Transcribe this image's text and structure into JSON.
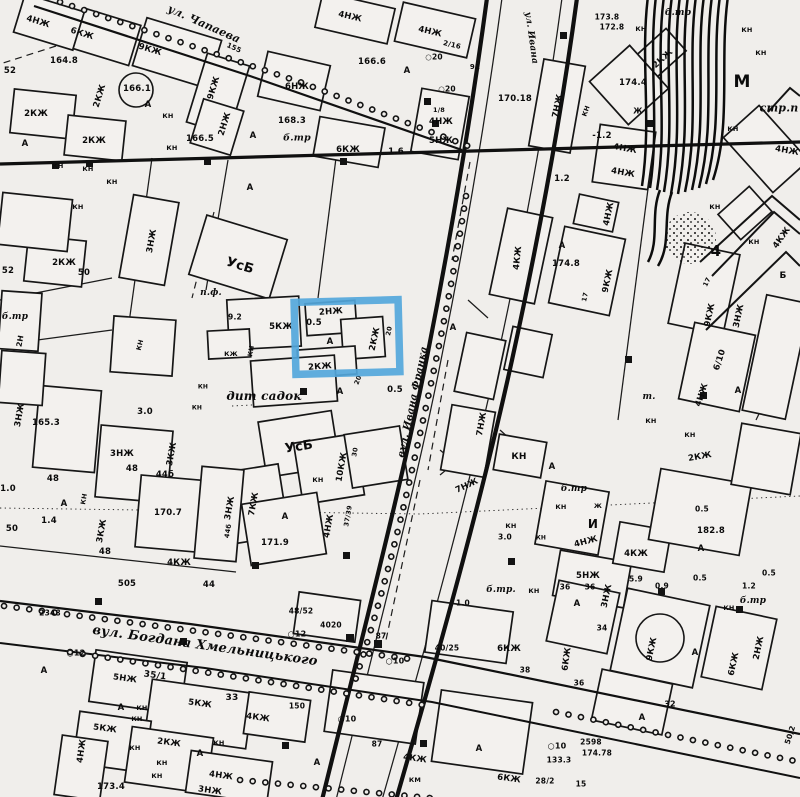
{
  "document": {
    "type": "scanned black-and-white city topographic map",
    "language": "Ukrainian / Russian",
    "annotation": "blue rectangle highlight over one building block"
  },
  "streets": [
    "ул. Чапаева",
    "вул. Ивана Франка",
    "вул. Богдана Хмельницького"
  ],
  "highlight": {
    "x": 295,
    "y": 301,
    "width": 104,
    "height": 72,
    "rotation": -1.5,
    "color": "#54a7db",
    "stroke_width": 7.5
  },
  "labels": [
    {
      "t": "4НЖ",
      "x": 38,
      "y": 22,
      "r": 17
    },
    {
      "t": "6КЖ",
      "x": 82,
      "y": 34,
      "r": 17
    },
    {
      "t": "9КЖ",
      "x": 150,
      "y": 50,
      "r": 17
    },
    {
      "t": "ул. Чапаева",
      "x": 204,
      "y": 24,
      "r": 24,
      "s": 11,
      "st": 1
    },
    {
      "t": "155",
      "x": 234,
      "y": 48,
      "r": 24,
      "s": 7
    },
    {
      "t": "164.8",
      "x": 64,
      "y": 61
    },
    {
      "t": "166.1",
      "x": 137,
      "y": 89
    },
    {
      "t": "2КЖ",
      "x": 100,
      "y": 96,
      "r": -73
    },
    {
      "t": "2КЖ",
      "x": 36,
      "y": 114
    },
    {
      "t": "2КЖ",
      "x": 94,
      "y": 141
    },
    {
      "t": "166.5",
      "x": 200,
      "y": 139
    },
    {
      "t": "КН",
      "x": 168,
      "y": 116,
      "s": 6.5
    },
    {
      "t": "КН",
      "x": 172,
      "y": 148,
      "s": 6.5
    },
    {
      "t": "КН",
      "x": 58,
      "y": 166,
      "s": 6.5
    },
    {
      "t": "КН",
      "x": 88,
      "y": 169,
      "s": 6.5
    },
    {
      "t": "КН",
      "x": 112,
      "y": 182,
      "s": 6.5
    },
    {
      "t": "9КЖ",
      "x": 214,
      "y": 88,
      "r": -73
    },
    {
      "t": "2НЖ",
      "x": 225,
      "y": 124,
      "r": -73
    },
    {
      "t": "52",
      "x": 10,
      "y": 71
    },
    {
      "t": "А",
      "x": 25,
      "y": 144
    },
    {
      "t": "А",
      "x": 148,
      "y": 105
    },
    {
      "t": "А",
      "x": 253,
      "y": 136
    },
    {
      "t": "А",
      "x": 250,
      "y": 188
    },
    {
      "t": "4НЖ",
      "x": 350,
      "y": 17,
      "r": 13
    },
    {
      "t": "4НЖ",
      "x": 430,
      "y": 32,
      "r": 13
    },
    {
      "t": "2/16",
      "x": 452,
      "y": 45,
      "r": 13,
      "s": 7
    },
    {
      "t": "166.6",
      "x": 372,
      "y": 62
    },
    {
      "t": "А",
      "x": 407,
      "y": 71
    },
    {
      "t": "○20",
      "x": 434,
      "y": 57,
      "s": 7.5
    },
    {
      "t": "○20",
      "x": 447,
      "y": 89,
      "s": 7.5
    },
    {
      "t": "6НЖ",
      "x": 297,
      "y": 87
    },
    {
      "t": "168.3",
      "x": 292,
      "y": 121
    },
    {
      "t": "б.тр",
      "x": 297,
      "y": 138,
      "s": 9.5,
      "st": 1
    },
    {
      "t": "6КЖ",
      "x": 348,
      "y": 150
    },
    {
      "t": "1.6",
      "x": 396,
      "y": 152
    },
    {
      "t": "1/8",
      "x": 439,
      "y": 110,
      "s": 6.5
    },
    {
      "t": "4НЖ",
      "x": 441,
      "y": 122
    },
    {
      "t": "5НЖ",
      "x": 441,
      "y": 141
    },
    {
      "t": "92",
      "x": 475,
      "y": 67,
      "s": 7
    },
    {
      "t": "170.18",
      "x": 515,
      "y": 99
    },
    {
      "t": "ул. Ивана",
      "x": 531,
      "y": 38,
      "r": 82,
      "s": 9,
      "st": 1
    },
    {
      "t": "173.8",
      "x": 607,
      "y": 17,
      "s": 7.5
    },
    {
      "t": "172.8",
      "x": 612,
      "y": 27,
      "s": 7.5
    },
    {
      "t": "б.тр",
      "x": 678,
      "y": 13,
      "s": 9,
      "st": 1
    },
    {
      "t": "КН",
      "x": 641,
      "y": 29,
      "s": 6.5
    },
    {
      "t": "КН",
      "x": 747,
      "y": 30,
      "s": 6.5
    },
    {
      "t": "КН",
      "x": 761,
      "y": 53,
      "s": 6.5
    },
    {
      "t": "2КЖ",
      "x": 663,
      "y": 59,
      "r": -42
    },
    {
      "t": "174.4",
      "x": 633,
      "y": 83
    },
    {
      "t": "7НЖ",
      "x": 558,
      "y": 106,
      "r": -78
    },
    {
      "t": "КН",
      "x": 586,
      "y": 111,
      "r": -70,
      "s": 6.5
    },
    {
      "t": "Ж",
      "x": 638,
      "y": 111,
      "s": 7.5
    },
    {
      "t": "-1.2",
      "x": 602,
      "y": 136
    },
    {
      "t": "4НЖ",
      "x": 625,
      "y": 149,
      "r": 10
    },
    {
      "t": "4НЖ",
      "x": 623,
      "y": 173,
      "r": 10
    },
    {
      "t": "1.2",
      "x": 562,
      "y": 179
    },
    {
      "t": "М",
      "x": 742,
      "y": 82,
      "s": 17
    },
    {
      "t": "стр.п",
      "x": 779,
      "y": 108,
      "s": 11,
      "st": 1
    },
    {
      "t": "КН",
      "x": 733,
      "y": 129,
      "s": 6.5
    },
    {
      "t": "4НЖ",
      "x": 787,
      "y": 151,
      "r": 10
    },
    {
      "t": "КН",
      "x": 78,
      "y": 207,
      "s": 6.5
    },
    {
      "t": "3НЖ",
      "x": 152,
      "y": 241,
      "r": -80
    },
    {
      "t": "52",
      "x": 8,
      "y": 271
    },
    {
      "t": "2КЖ",
      "x": 64,
      "y": 263
    },
    {
      "t": "50",
      "x": 84,
      "y": 273
    },
    {
      "t": "б.тр",
      "x": 15,
      "y": 317,
      "s": 9,
      "st": 1
    },
    {
      "t": "2Н",
      "x": 20,
      "y": 341,
      "r": -80,
      "s": 7.5
    },
    {
      "t": "УсБ",
      "x": 240,
      "y": 266,
      "r": 17,
      "s": 13
    },
    {
      "t": "п.ф.",
      "x": 211,
      "y": 293,
      "s": 9,
      "st": 1
    },
    {
      "t": "КН",
      "x": 251,
      "y": 351,
      "r": -80,
      "s": 6.5
    },
    {
      "t": "9.2",
      "x": 235,
      "y": 317,
      "s": 7.5
    },
    {
      "t": "165.3",
      "x": 46,
      "y": 423
    },
    {
      "t": "3НЖ",
      "x": 20,
      "y": 415,
      "r": -80
    },
    {
      "t": "5КЖ",
      "x": 281,
      "y": 327
    },
    {
      "t": "КЖ",
      "x": 231,
      "y": 354,
      "s": 6.5
    },
    {
      "t": "КН",
      "x": 140,
      "y": 345,
      "r": -75,
      "s": 6.5
    },
    {
      "t": "2НЖ",
      "x": 331,
      "y": 312,
      "r": -4
    },
    {
      "t": "0.5",
      "x": 314,
      "y": 323
    },
    {
      "t": "А",
      "x": 330,
      "y": 342
    },
    {
      "t": "2КЖ",
      "x": 375,
      "y": 339,
      "r": -78
    },
    {
      "t": "20",
      "x": 389,
      "y": 331,
      "r": -78,
      "s": 6.5
    },
    {
      "t": "2КЖ",
      "x": 320,
      "y": 367,
      "r": -4
    },
    {
      "t": "20",
      "x": 358,
      "y": 380,
      "r": -70,
      "s": 6.5
    },
    {
      "t": "0.5",
      "x": 395,
      "y": 390
    },
    {
      "t": "А",
      "x": 340,
      "y": 392
    },
    {
      "t": "дит садок",
      "x": 264,
      "y": 396,
      "s": 12,
      "st": 1
    },
    {
      "t": "3.0",
      "x": 145,
      "y": 412
    },
    {
      "t": "КН",
      "x": 203,
      "y": 387,
      "s": 6
    },
    {
      "t": "КН",
      "x": 197,
      "y": 408,
      "s": 6
    },
    {
      "t": "вул. Ивана Франка",
      "x": 413,
      "y": 402,
      "r": -78,
      "s": 10,
      "st": 1
    },
    {
      "t": "А",
      "x": 453,
      "y": 328
    },
    {
      "t": "УсБ",
      "x": 299,
      "y": 447,
      "r": -9,
      "s": 13
    },
    {
      "t": "10КЖ",
      "x": 342,
      "y": 467,
      "r": -80
    },
    {
      "t": "30",
      "x": 355,
      "y": 452,
      "r": -80,
      "s": 6.5
    },
    {
      "t": "КН",
      "x": 318,
      "y": 480,
      "s": 6.5
    },
    {
      "t": "7КЖ",
      "x": 254,
      "y": 504,
      "r": -80
    },
    {
      "t": "А",
      "x": 285,
      "y": 517
    },
    {
      "t": "171.9",
      "x": 275,
      "y": 543
    },
    {
      "t": "4НЖ",
      "x": 329,
      "y": 526,
      "r": -80
    },
    {
      "t": "37/39",
      "x": 348,
      "y": 516,
      "r": -80,
      "s": 6.5
    },
    {
      "t": "3КЖ",
      "x": 102,
      "y": 531,
      "r": -80
    },
    {
      "t": "48",
      "x": 105,
      "y": 552
    },
    {
      "t": "48",
      "x": 53,
      "y": 479
    },
    {
      "t": "1.0",
      "x": 8,
      "y": 489
    },
    {
      "t": "А",
      "x": 64,
      "y": 504
    },
    {
      "t": "1.4",
      "x": 49,
      "y": 521
    },
    {
      "t": "50",
      "x": 12,
      "y": 529
    },
    {
      "t": "КН",
      "x": 84,
      "y": 499,
      "r": -80,
      "s": 6.5
    },
    {
      "t": "3НЖ",
      "x": 122,
      "y": 454
    },
    {
      "t": "48",
      "x": 132,
      "y": 469
    },
    {
      "t": "44б",
      "x": 165,
      "y": 475
    },
    {
      "t": "3КЖ",
      "x": 172,
      "y": 454,
      "r": -80
    },
    {
      "t": "170.7",
      "x": 168,
      "y": 513
    },
    {
      "t": "4КЖ",
      "x": 179,
      "y": 563
    },
    {
      "t": "505",
      "x": 127,
      "y": 584
    },
    {
      "t": "3НЖ",
      "x": 230,
      "y": 508,
      "r": -80
    },
    {
      "t": "44б",
      "x": 228,
      "y": 531,
      "r": -80,
      "s": 6.5
    },
    {
      "t": "7НЖ",
      "x": 482,
      "y": 424,
      "r": -80
    },
    {
      "t": "7НЖ",
      "x": 467,
      "y": 486,
      "r": -25
    },
    {
      "t": "4НЖ",
      "x": 609,
      "y": 214,
      "r": -78
    },
    {
      "t": "КН",
      "x": 715,
      "y": 207,
      "s": 6.5
    },
    {
      "t": "4КЖ",
      "x": 518,
      "y": 258,
      "r": -84
    },
    {
      "t": "А",
      "x": 562,
      "y": 246
    },
    {
      "t": "174.8",
      "x": 566,
      "y": 264
    },
    {
      "t": "9КЖ",
      "x": 608,
      "y": 281,
      "r": -78
    },
    {
      "t": "17",
      "x": 585,
      "y": 297,
      "r": -78,
      "s": 6.5
    },
    {
      "t": "4",
      "x": 716,
      "y": 251,
      "s": 15
    },
    {
      "t": "КН",
      "x": 754,
      "y": 242,
      "s": 6.5
    },
    {
      "t": "4КЖ",
      "x": 782,
      "y": 238,
      "r": -55
    },
    {
      "t": "17",
      "x": 707,
      "y": 282,
      "r": -65,
      "s": 6.5
    },
    {
      "t": "9КЖ",
      "x": 710,
      "y": 315,
      "r": -78
    },
    {
      "t": "3НЖ",
      "x": 739,
      "y": 316,
      "r": -78
    },
    {
      "t": "6/10",
      "x": 720,
      "y": 360,
      "r": -72
    },
    {
      "t": "4НЖ",
      "x": 702,
      "y": 395,
      "r": -72
    },
    {
      "t": "А",
      "x": 738,
      "y": 391
    },
    {
      "t": "т.",
      "x": 649,
      "y": 397,
      "s": 9,
      "st": 1
    },
    {
      "t": "КН",
      "x": 651,
      "y": 421,
      "s": 6.5
    },
    {
      "t": "Б",
      "x": 783,
      "y": 276,
      "s": 9
    },
    {
      "t": "КН",
      "x": 690,
      "y": 435,
      "s": 6.5
    },
    {
      "t": "2КЖ",
      "x": 700,
      "y": 457,
      "r": -10
    },
    {
      "t": "КН",
      "x": 519,
      "y": 457,
      "s": 9
    },
    {
      "t": "А",
      "x": 552,
      "y": 467
    },
    {
      "t": "б.тр",
      "x": 574,
      "y": 489,
      "s": 9,
      "st": 1
    },
    {
      "t": "КН",
      "x": 561,
      "y": 507,
      "s": 6.5
    },
    {
      "t": "Ж",
      "x": 598,
      "y": 506,
      "s": 6.5
    },
    {
      "t": "И",
      "x": 593,
      "y": 524,
      "s": 12
    },
    {
      "t": "КН",
      "x": 511,
      "y": 526,
      "s": 6.5
    },
    {
      "t": "3.0",
      "x": 505,
      "y": 537,
      "s": 7.5
    },
    {
      "t": "КН",
      "x": 541,
      "y": 538,
      "s": 6
    },
    {
      "t": "4НЖ",
      "x": 586,
      "y": 542,
      "r": -15
    },
    {
      "t": "4КЖ",
      "x": 636,
      "y": 554
    },
    {
      "t": "5НЖ",
      "x": 588,
      "y": 576
    },
    {
      "t": "36",
      "x": 590,
      "y": 587,
      "s": 7.5
    },
    {
      "t": "5.9",
      "x": 636,
      "y": 579,
      "s": 7.5
    },
    {
      "t": "0.9",
      "x": 662,
      "y": 586,
      "s": 7.5
    },
    {
      "t": "0.5",
      "x": 700,
      "y": 578,
      "s": 7.5
    },
    {
      "t": "0.5",
      "x": 702,
      "y": 509,
      "s": 7.5
    },
    {
      "t": "182.8",
      "x": 711,
      "y": 531
    },
    {
      "t": "А",
      "x": 701,
      "y": 549
    },
    {
      "t": "0.5",
      "x": 769,
      "y": 573,
      "s": 7.5
    },
    {
      "t": "1.2",
      "x": 749,
      "y": 586,
      "s": 7.5
    },
    {
      "t": "б.тр",
      "x": 753,
      "y": 601,
      "s": 9,
      "st": 1
    },
    {
      "t": "КН",
      "x": 729,
      "y": 608,
      "s": 6.5
    },
    {
      "t": "вул. Богдана Хмельницького",
      "x": 205,
      "y": 646,
      "r": 8,
      "s": 13,
      "st": 1
    },
    {
      "t": "2348",
      "x": 50,
      "y": 613,
      "s": 7.5
    },
    {
      "t": "○12",
      "x": 76,
      "y": 653,
      "s": 8
    },
    {
      "t": "44",
      "x": 209,
      "y": 585
    },
    {
      "t": "48/52",
      "x": 301,
      "y": 611,
      "s": 7.5
    },
    {
      "t": "4020",
      "x": 331,
      "y": 625,
      "s": 7.5
    },
    {
      "t": "○12",
      "x": 297,
      "y": 634,
      "s": 8
    },
    {
      "t": "87",
      "x": 381,
      "y": 636,
      "s": 7.5
    },
    {
      "t": "○10",
      "x": 395,
      "y": 661,
      "s": 8
    },
    {
      "t": "б.тр.",
      "x": 501,
      "y": 590,
      "s": 9,
      "st": 1
    },
    {
      "t": "1.0",
      "x": 463,
      "y": 603,
      "s": 7.5
    },
    {
      "t": "КН",
      "x": 534,
      "y": 591,
      "s": 6.5
    },
    {
      "t": "40/25",
      "x": 447,
      "y": 648,
      "s": 7.5
    },
    {
      "t": "6КЖ",
      "x": 509,
      "y": 649
    },
    {
      "t": "38",
      "x": 525,
      "y": 670,
      "s": 7.5
    },
    {
      "t": "150",
      "x": 297,
      "y": 706,
      "s": 7.5
    },
    {
      "t": "○10",
      "x": 347,
      "y": 719,
      "s": 8
    },
    {
      "t": "87",
      "x": 377,
      "y": 744,
      "s": 7.5
    },
    {
      "t": "4КЖ",
      "x": 415,
      "y": 759,
      "r": 8
    },
    {
      "t": "КМ",
      "x": 415,
      "y": 780,
      "s": 6.5
    },
    {
      "t": "А",
      "x": 479,
      "y": 749
    },
    {
      "t": "А",
      "x": 317,
      "y": 763
    },
    {
      "t": "6КЖ",
      "x": 509,
      "y": 779,
      "r": 8
    },
    {
      "t": "28/2",
      "x": 545,
      "y": 781,
      "s": 7.5
    },
    {
      "t": "133.3",
      "x": 559,
      "y": 760,
      "s": 7.5
    },
    {
      "t": "○10",
      "x": 557,
      "y": 746,
      "s": 8
    },
    {
      "t": "2598",
      "x": 591,
      "y": 742,
      "s": 7.5
    },
    {
      "t": "174.78",
      "x": 597,
      "y": 753,
      "s": 7.5
    },
    {
      "t": "15",
      "x": 581,
      "y": 784,
      "s": 7.5
    },
    {
      "t": "А",
      "x": 44,
      "y": 671
    },
    {
      "t": "5НЖ",
      "x": 125,
      "y": 679,
      "r": 8
    },
    {
      "t": "35/1",
      "x": 155,
      "y": 676,
      "r": 8,
      "s": 9
    },
    {
      "t": "33",
      "x": 232,
      "y": 698,
      "s": 9
    },
    {
      "t": "5КЖ",
      "x": 200,
      "y": 704,
      "r": 8
    },
    {
      "t": "4КЖ",
      "x": 258,
      "y": 718,
      "r": 8
    },
    {
      "t": "КН",
      "x": 142,
      "y": 708,
      "s": 6.5
    },
    {
      "t": "КН",
      "x": 137,
      "y": 719,
      "s": 6.5
    },
    {
      "t": "5КЖ",
      "x": 105,
      "y": 729,
      "r": 8
    },
    {
      "t": "А",
      "x": 121,
      "y": 708
    },
    {
      "t": "2КЖ",
      "x": 169,
      "y": 743,
      "r": 8
    },
    {
      "t": "КН",
      "x": 135,
      "y": 748,
      "s": 6.5
    },
    {
      "t": "КН",
      "x": 219,
      "y": 743,
      "s": 6.5
    },
    {
      "t": "А",
      "x": 200,
      "y": 754
    },
    {
      "t": "КН",
      "x": 162,
      "y": 763,
      "s": 6.5
    },
    {
      "t": "КН",
      "x": 157,
      "y": 776,
      "s": 6.5
    },
    {
      "t": "4НЖ",
      "x": 82,
      "y": 751,
      "r": -82
    },
    {
      "t": "173.4",
      "x": 111,
      "y": 787
    },
    {
      "t": "3НЖ",
      "x": 210,
      "y": 791,
      "r": 8
    },
    {
      "t": "4НЖ",
      "x": 221,
      "y": 776,
      "r": 8
    },
    {
      "t": "36",
      "x": 565,
      "y": 587,
      "s": 7.5
    },
    {
      "t": "3НЖ",
      "x": 607,
      "y": 596,
      "r": -78
    },
    {
      "t": "А",
      "x": 577,
      "y": 604
    },
    {
      "t": "34",
      "x": 602,
      "y": 628,
      "s": 7.5
    },
    {
      "t": "6КЖ",
      "x": 567,
      "y": 659,
      "r": -82
    },
    {
      "t": "36",
      "x": 579,
      "y": 683,
      "s": 7.5
    },
    {
      "t": "9КЖ",
      "x": 652,
      "y": 649,
      "r": -78
    },
    {
      "t": "А",
      "x": 695,
      "y": 653
    },
    {
      "t": "6КЖ",
      "x": 734,
      "y": 664,
      "r": -78
    },
    {
      "t": "2НЖ",
      "x": 759,
      "y": 648,
      "r": -78
    },
    {
      "t": "32",
      "x": 670,
      "y": 704,
      "s": 8
    },
    {
      "t": "А",
      "x": 642,
      "y": 718
    },
    {
      "t": "50/2",
      "x": 790,
      "y": 735,
      "r": -72,
      "s": 7.5
    }
  ]
}
